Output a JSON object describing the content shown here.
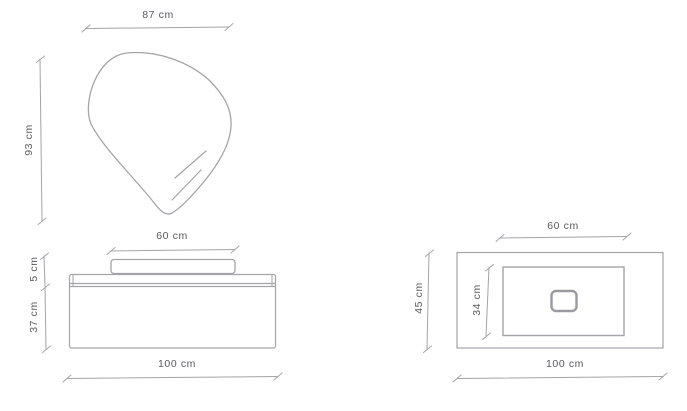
{
  "diagram": {
    "type": "furniture-dimension-drawing",
    "subject": "vanity-with-mirror-basin-and-countertop",
    "unit": "cm",
    "colors": {
      "line": "#a4a4a9",
      "text": "#5a5a61",
      "background": "#ffffff"
    },
    "front_view": {
      "mirror_width_label": "87 cm",
      "mirror_height_label": "93 cm",
      "basin_width_label": "60 cm",
      "basin_height_label": "5 cm",
      "cabinet_height_label": "37 cm",
      "total_width_label": "100 cm"
    },
    "top_view": {
      "basin_width_label": "60 cm",
      "countertop_depth_label": "45 cm",
      "basin_depth_label": "34 cm",
      "total_width_label": "100 cm"
    }
  }
}
